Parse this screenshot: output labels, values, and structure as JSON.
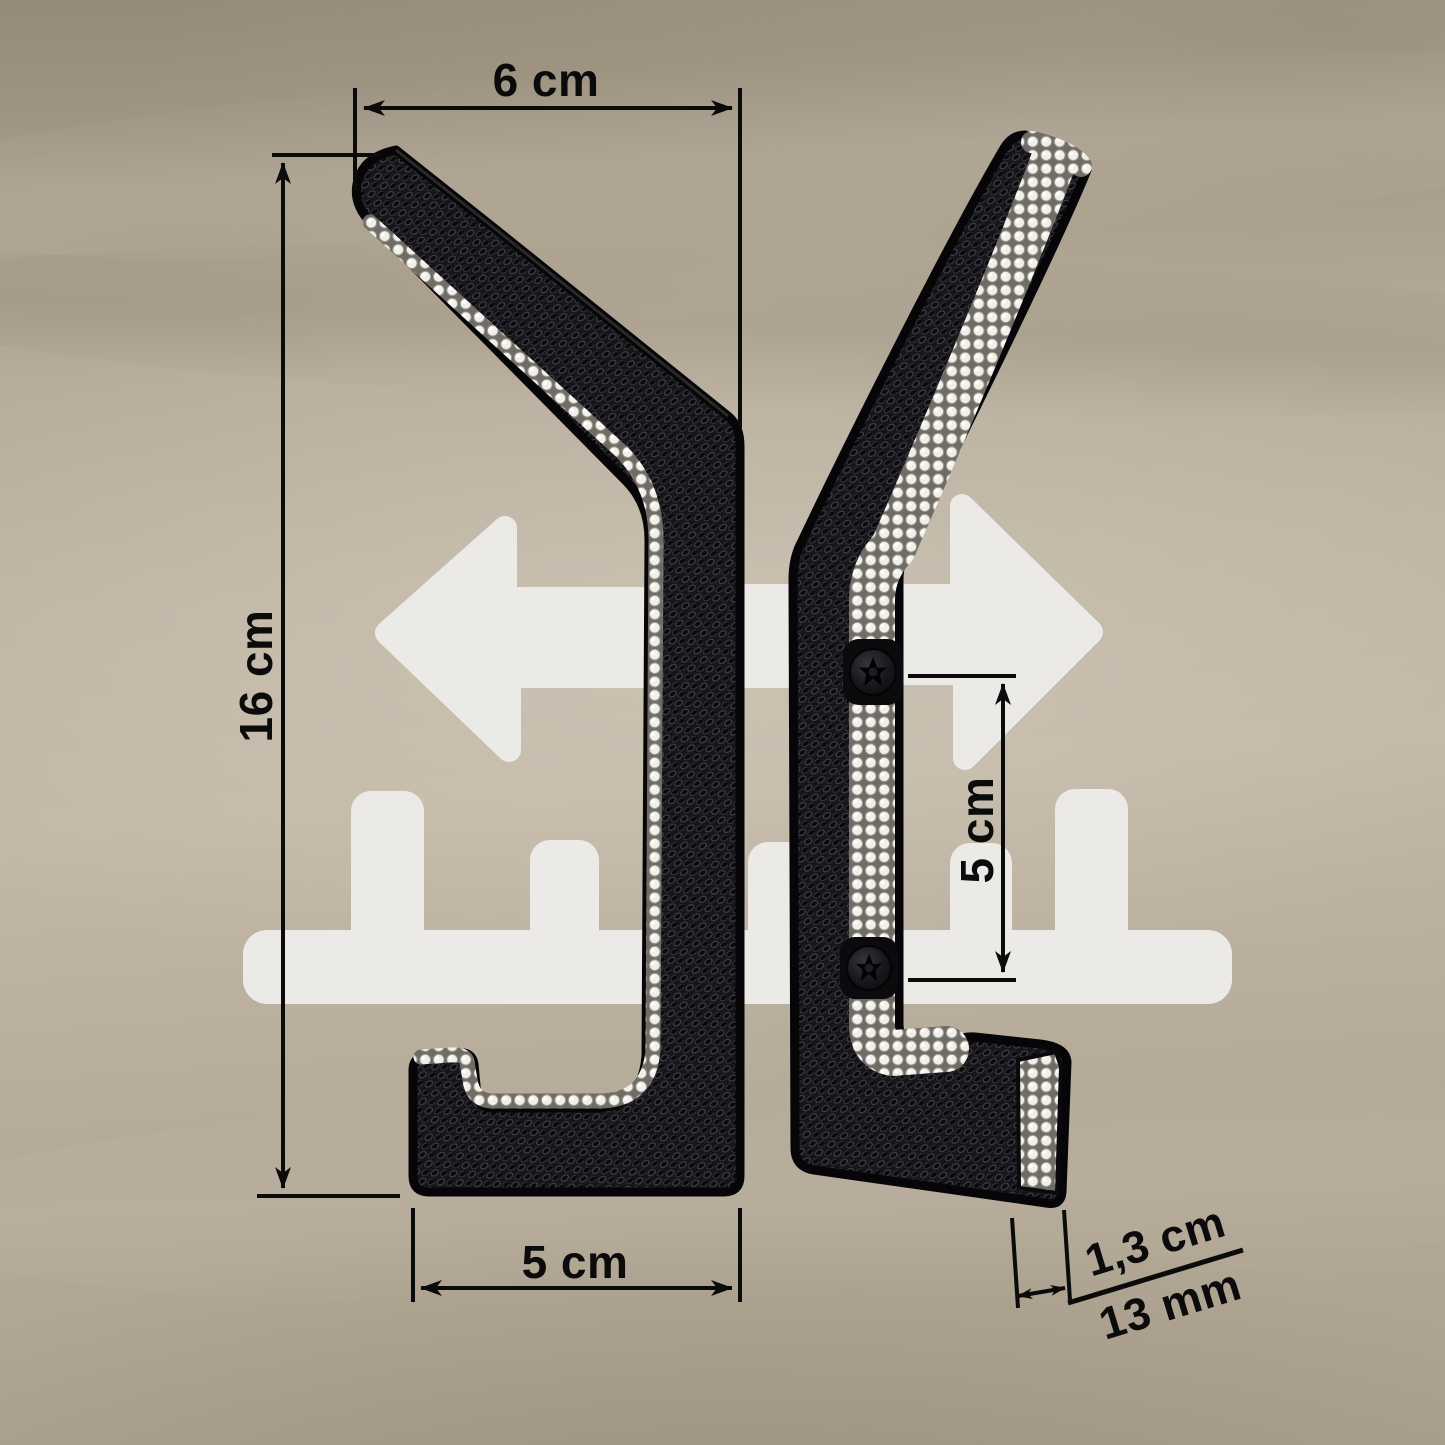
{
  "title": "Coat hook dimension diagram",
  "colors": {
    "background": "#B7AB9A",
    "silhouette": "#ECEAE7",
    "annotation": "#0B0B0B",
    "hook_body": "#17171A",
    "crystal": "#F5F3EF"
  },
  "annotations": {
    "hook_reach": {
      "label": "6 cm"
    },
    "hook_height": {
      "label": "16 cm"
    },
    "base_depth": {
      "label": "5 cm"
    },
    "screw_spacing": {
      "label": "5 cm"
    },
    "thickness_cm": {
      "label": "1,3 cm"
    },
    "thickness_mm": {
      "label": "13 mm"
    }
  },
  "icons": {
    "left_arrow": "left-arrow",
    "right_arrow": "right-arrow",
    "coat_rack": "coat-rack-silhouette",
    "screw_count": 2
  }
}
